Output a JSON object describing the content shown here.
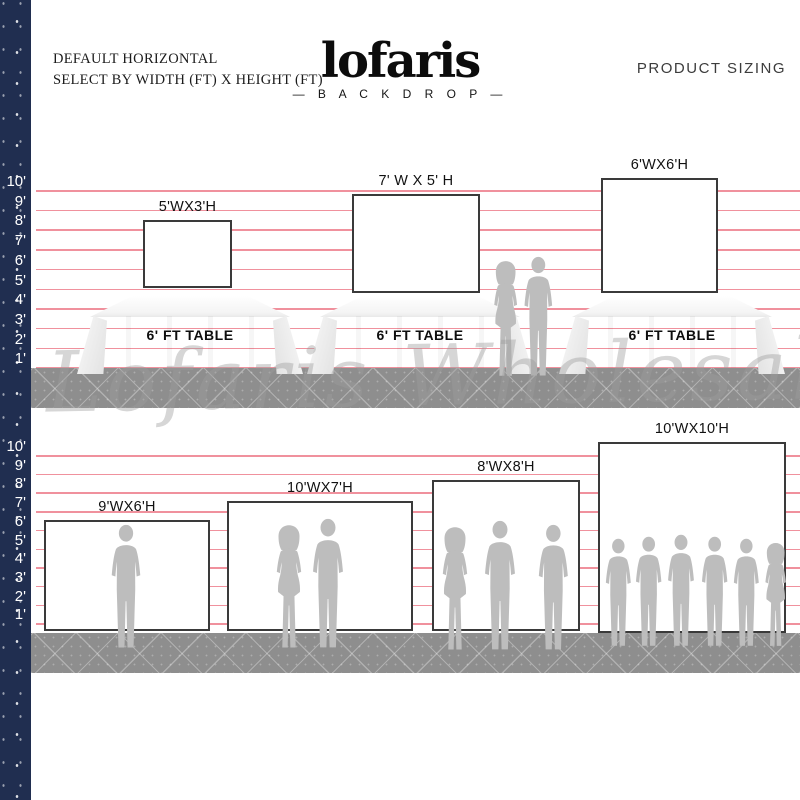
{
  "header": {
    "instruction_line1": "DEFAULT HORIZONTAL",
    "instruction_line2": "SELECT BY WIDTH (FT) X HEIGHT (FT)",
    "brand_name": "lofaris",
    "brand_tagline": "— B A C K D R O P —",
    "page_label": "PRODUCT SIZING"
  },
  "watermark_text": "Lofaris Wholesale",
  "ruler_labels": [
    "10'",
    "9'",
    "8'",
    "7'",
    "6'",
    "5'",
    "4'",
    "3'",
    "2'",
    "1'"
  ],
  "sections": [
    {
      "name": "tabletop-backdrops",
      "backdrops": [
        {
          "label": "5'WX3'H",
          "width_ft": 5,
          "height_ft": 3
        },
        {
          "label": "7' W X 5' H",
          "width_ft": 7,
          "height_ft": 5
        },
        {
          "label": "6'WX6'H",
          "width_ft": 6,
          "height_ft": 6
        }
      ],
      "tables": [
        {
          "label": "6' FT TABLE"
        },
        {
          "label": "6' FT TABLE"
        },
        {
          "label": "6' FT TABLE"
        }
      ]
    },
    {
      "name": "floor-backdrops",
      "backdrops": [
        {
          "label": "9'WX6'H",
          "width_ft": 9,
          "height_ft": 6
        },
        {
          "label": "10'WX7'H",
          "width_ft": 10,
          "height_ft": 7
        },
        {
          "label": "8'WX8'H",
          "width_ft": 8,
          "height_ft": 8
        },
        {
          "label": "10'WX10'H",
          "width_ft": 10,
          "height_ft": 10
        }
      ]
    }
  ],
  "colors": {
    "navy": "#202e50",
    "grid_line": "#f0919d",
    "floor": "#8e8e8e",
    "silhouette": "#bdbdbd",
    "backdrop_border": "#3a3a3a",
    "text": "#1a1a1a"
  }
}
